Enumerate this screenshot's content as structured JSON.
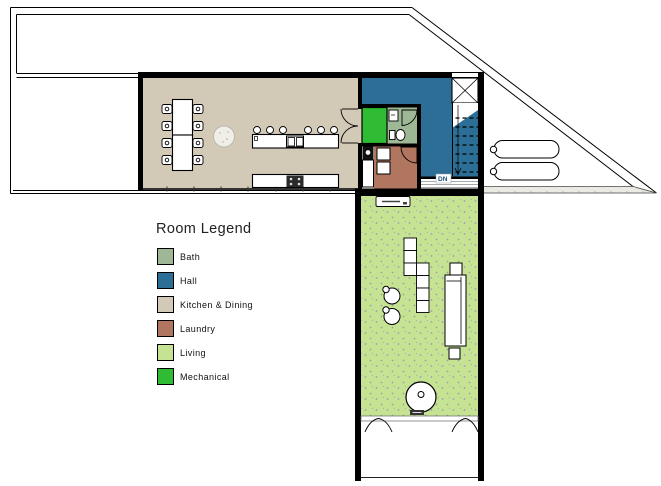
{
  "legend": {
    "title": "Room Legend",
    "items": [
      {
        "label": "Bath",
        "color": "#9eb896"
      },
      {
        "label": "Hall",
        "color": "#2c6e95"
      },
      {
        "label": "Kitchen & Dining",
        "color": "#d2c9b6"
      },
      {
        "label": "Laundry",
        "color": "#b0765f"
      },
      {
        "label": "Living",
        "color": "#c6e394"
      },
      {
        "label": "Mechanical",
        "color": "#2fbb34"
      }
    ]
  },
  "plan": {
    "stairs_down_label": "DN"
  }
}
